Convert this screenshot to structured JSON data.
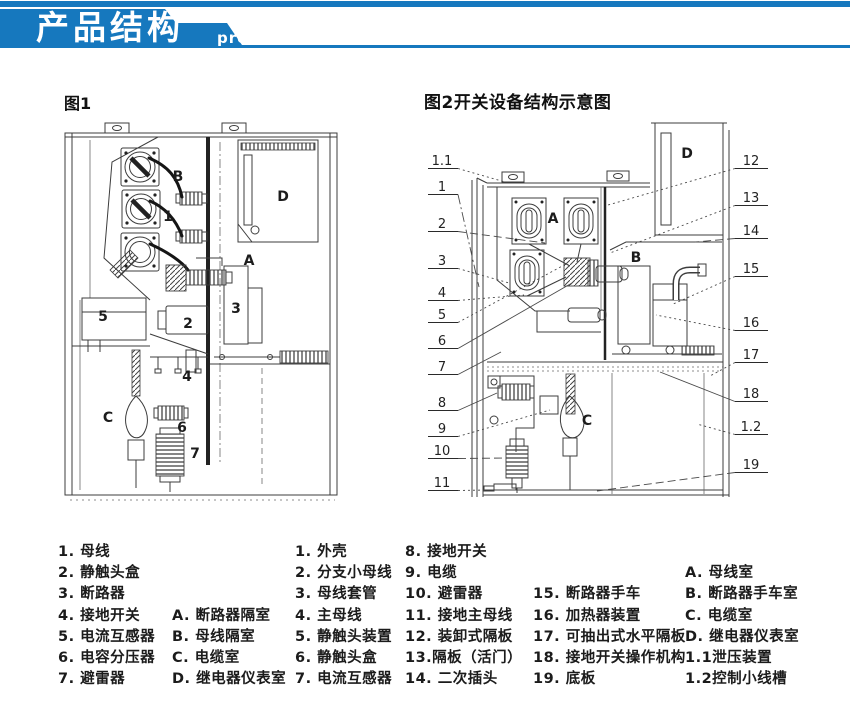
{
  "header": {
    "title_zh": "产品结构",
    "title_en": "product mix",
    "banner_color": "#1678be"
  },
  "figure1": {
    "caption": "图1",
    "labels": [
      {
        "t": "B",
        "x": 178,
        "y": 181
      },
      {
        "t": "1",
        "x": 168,
        "y": 221
      },
      {
        "t": "D",
        "x": 283,
        "y": 201
      },
      {
        "t": "A",
        "x": 249,
        "y": 265
      },
      {
        "t": "5",
        "x": 103,
        "y": 321
      },
      {
        "t": "2",
        "x": 188,
        "y": 328
      },
      {
        "t": "3",
        "x": 236,
        "y": 313
      },
      {
        "t": "4",
        "x": 187,
        "y": 381
      },
      {
        "t": "C",
        "x": 108,
        "y": 422
      },
      {
        "t": "6",
        "x": 182,
        "y": 432
      },
      {
        "t": "7",
        "x": 195,
        "y": 458
      }
    ]
  },
  "figure2": {
    "caption": "图2开关设备结构示意图",
    "labels": [
      {
        "t": "A",
        "x": 553,
        "y": 223
      },
      {
        "t": "B",
        "x": 636,
        "y": 262
      },
      {
        "t": "C",
        "x": 587,
        "y": 425
      },
      {
        "t": "D",
        "x": 687,
        "y": 158
      }
    ],
    "left_callouts": [
      {
        "t": "1.1",
        "y": 165,
        "tx": 505,
        "ty": 182,
        "style": "dot"
      },
      {
        "t": "1",
        "y": 191,
        "tx": 479,
        "ty": 287,
        "style": "dashdot"
      },
      {
        "t": "2",
        "y": 228,
        "tx": 545,
        "ty": 243,
        "style": "dash"
      },
      {
        "t": "3",
        "y": 265,
        "tx": 509,
        "ty": 283,
        "style": "dot"
      },
      {
        "t": "4",
        "y": 297,
        "tx": 524,
        "ty": 295,
        "style": "dot"
      },
      {
        "t": "5",
        "y": 319,
        "tx": 566,
        "ty": 264,
        "style": "dot"
      },
      {
        "t": "6",
        "y": 345,
        "tx": 572,
        "ty": 283,
        "style": "solid"
      },
      {
        "t": "7",
        "y": 371,
        "tx": 501,
        "ty": 352,
        "style": "solid"
      },
      {
        "t": "8",
        "y": 407,
        "tx": 497,
        "ty": 393,
        "style": "solid"
      },
      {
        "t": "9",
        "y": 433,
        "tx": 550,
        "ty": 410,
        "style": "dot"
      },
      {
        "t": "10",
        "y": 455,
        "tx": 505,
        "ty": 458,
        "style": "dash"
      },
      {
        "t": "11",
        "y": 487,
        "tx": 488,
        "ty": 490,
        "style": "dot"
      }
    ],
    "right_callouts": [
      {
        "t": "12",
        "y": 165,
        "tx": 608,
        "ty": 205,
        "style": "dot"
      },
      {
        "t": "13",
        "y": 202,
        "tx": 610,
        "ty": 253,
        "style": "dot"
      },
      {
        "t": "14",
        "y": 235,
        "tx": 695,
        "ty": 242,
        "style": "dash"
      },
      {
        "t": "15",
        "y": 273,
        "tx": 671,
        "ty": 305,
        "style": "dot"
      },
      {
        "t": "16",
        "y": 327,
        "tx": 656,
        "ty": 315,
        "style": "dot"
      },
      {
        "t": "17",
        "y": 359,
        "tx": 710,
        "ty": 376,
        "style": "dot"
      },
      {
        "t": "18",
        "y": 398,
        "tx": 660,
        "ty": 372,
        "style": "solid"
      },
      {
        "t": "1.2",
        "y": 431,
        "tx": 697,
        "ty": 424,
        "style": "dot"
      },
      {
        "t": "19",
        "y": 469,
        "tx": 597,
        "ty": 491,
        "style": "dash"
      }
    ]
  },
  "legend": {
    "row_top_start": 544,
    "row_step": 21.2,
    "columns": [
      {
        "x": 58,
        "items": [
          {
            "row": 1,
            "text": "1. 母线"
          },
          {
            "row": 2,
            "text": "2. 静触头盒"
          },
          {
            "row": 3,
            "text": "3. 断路器"
          },
          {
            "row": 4,
            "text": "4. 接地开关"
          },
          {
            "row": 5,
            "text": "5. 电流互感器"
          },
          {
            "row": 6,
            "text": "6. 电容分压器"
          },
          {
            "row": 7,
            "text": "7. 避雷器"
          }
        ]
      },
      {
        "x": 172,
        "items": [
          {
            "row": 4,
            "text": "A. 断路器隔室"
          },
          {
            "row": 5,
            "text": "B. 母线隔室"
          },
          {
            "row": 6,
            "text": "C. 电缆室"
          },
          {
            "row": 7,
            "text": "D. 继电器仪表室"
          }
        ]
      },
      {
        "x": 295,
        "items": [
          {
            "row": 1,
            "text": "1. 外壳"
          },
          {
            "row": 2,
            "text": "2. 分支小母线"
          },
          {
            "row": 3,
            "text": "3. 母线套管"
          },
          {
            "row": 4,
            "text": "4. 主母线"
          },
          {
            "row": 5,
            "text": "5. 静触头装置"
          },
          {
            "row": 6,
            "text": "6. 静触头盒"
          },
          {
            "row": 7,
            "text": "7. 电流互感器"
          }
        ]
      },
      {
        "x": 405,
        "items": [
          {
            "row": 1,
            "text": "8. 接地开关"
          },
          {
            "row": 2,
            "text": "9. 电缆"
          },
          {
            "row": 3,
            "text": "10. 避雷器"
          },
          {
            "row": 4,
            "text": "11. 接地主母线"
          },
          {
            "row": 5,
            "text": "12. 装卸式隔板"
          },
          {
            "row": 6,
            "text": "13.隔板（活门）"
          },
          {
            "row": 7,
            "text": "14. 二次插头"
          }
        ]
      },
      {
        "x": 533,
        "items": [
          {
            "row": 3,
            "text": "15. 断路器手车"
          },
          {
            "row": 4,
            "text": "16. 加热器装置"
          },
          {
            "row": 5,
            "text": "17. 可抽出式水平隔板"
          },
          {
            "row": 6,
            "text": "18. 接地开关操作机构"
          },
          {
            "row": 7,
            "text": "19. 底板"
          }
        ]
      },
      {
        "x": 685,
        "items": [
          {
            "row": 2,
            "text": "A.  母线室"
          },
          {
            "row": 3,
            "text": "B.  断路器手车室"
          },
          {
            "row": 4,
            "text": "C.  电缆室"
          },
          {
            "row": 5,
            "text": "D.  继电器仪表室"
          },
          {
            "row": 6,
            "text": "1.1泄压装置"
          },
          {
            "row": 7,
            "text": "1.2控制小线槽"
          }
        ]
      }
    ]
  }
}
